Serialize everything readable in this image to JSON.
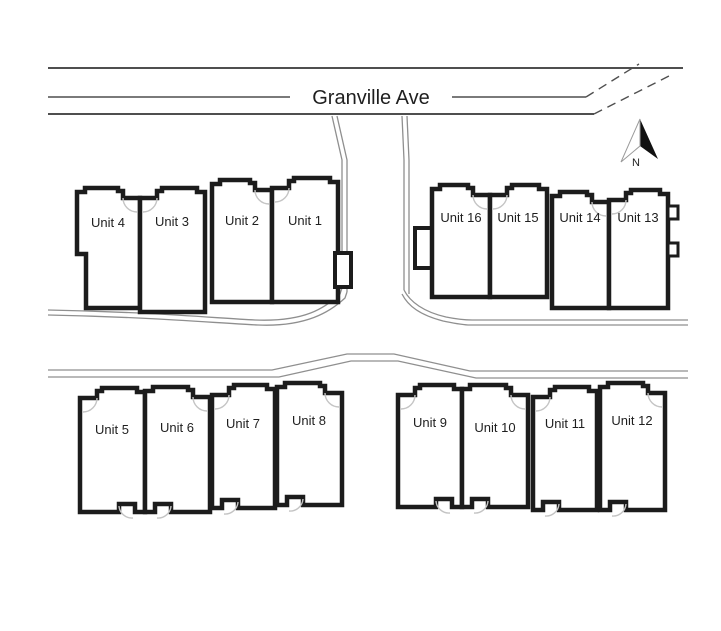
{
  "street": {
    "label": "Granville Ave"
  },
  "compass": {
    "north_label": "N"
  },
  "blocks": [
    {
      "name": "north-west-block",
      "units": [
        {
          "label": "Unit 4"
        },
        {
          "label": "Unit 3"
        },
        {
          "label": "Unit 2"
        },
        {
          "label": "Unit 1"
        }
      ]
    },
    {
      "name": "north-east-block",
      "units": [
        {
          "label": "Unit 16"
        },
        {
          "label": "Unit 15"
        },
        {
          "label": "Unit 14"
        },
        {
          "label": "Unit 13"
        }
      ]
    },
    {
      "name": "south-west-block",
      "units": [
        {
          "label": "Unit 5"
        },
        {
          "label": "Unit 6"
        },
        {
          "label": "Unit 7"
        },
        {
          "label": "Unit 8"
        }
      ]
    },
    {
      "name": "south-east-block",
      "units": [
        {
          "label": "Unit 9"
        },
        {
          "label": "Unit 10"
        },
        {
          "label": "Unit 11"
        },
        {
          "label": "Unit 12"
        }
      ]
    }
  ],
  "colors": {
    "outline": "#1c1c1c",
    "road": "#4f4f4f",
    "lane": "#8f8f8f",
    "door_arc": "#c4c4c4",
    "text": "#1f1f1f",
    "background": "#ffffff"
  }
}
